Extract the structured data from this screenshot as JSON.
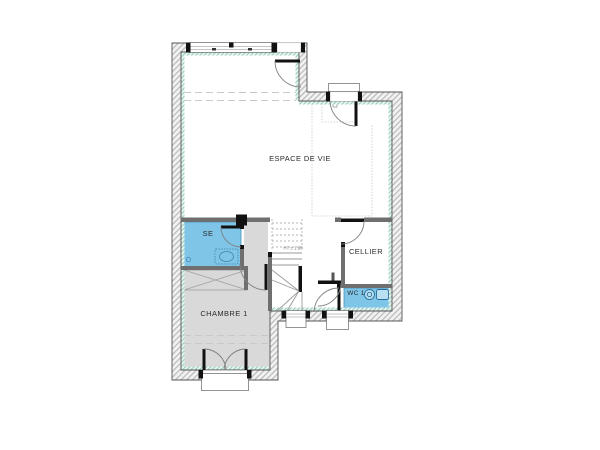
{
  "plan": {
    "type": "architectural-floor-plan",
    "rooms": [
      {
        "id": "espace-de-vie",
        "label": "ESPACE DE VIE",
        "floor_fill": "#ffffff"
      },
      {
        "id": "chambre-1",
        "label": "CHAMBRE 1",
        "floor_fill": "#d9d9d9"
      },
      {
        "id": "se",
        "label": "SE",
        "floor_fill": "#7ec5e8"
      },
      {
        "id": "cellier",
        "label": "CELLIER",
        "floor_fill": "#ffffff"
      },
      {
        "id": "wc-1",
        "label": "WC 1",
        "floor_fill": "#7ec5e8"
      }
    ],
    "annotations": {
      "stair_height_note": "HT ± 1.80"
    },
    "features": [
      "stairs-with-winders",
      "entry-door",
      "french-door",
      "windows",
      "wc-toilet",
      "se-washbasin",
      "closet-crossed"
    ],
    "colors": {
      "wet_room_fill": "#7ec5e8",
      "wet_room_stroke": "#4a8fba",
      "bedroom_fill": "#d9d9d9",
      "insulation_teal": "#96cbbf",
      "wall_hatch": "#b9b9b9",
      "partition_gray": "#6f6f6f",
      "door_leaf_black": "#111111"
    }
  }
}
